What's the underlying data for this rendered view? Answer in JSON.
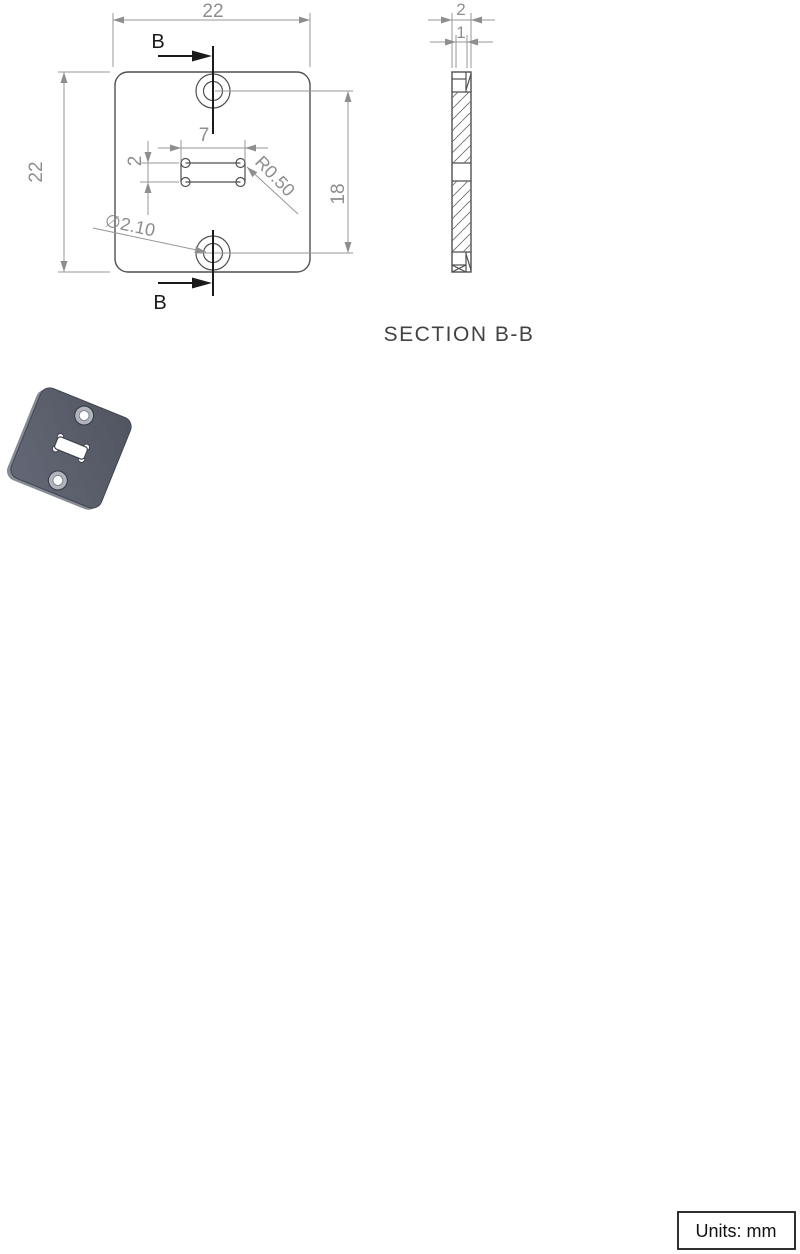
{
  "front_view": {
    "overall_width": "22",
    "overall_height": "22",
    "slot_length": "7",
    "slot_width": "2",
    "hole_spacing": "18",
    "slot_corner_radius": "R0.50",
    "hole_diameter": "∅2.10",
    "section_arrow_top": "B",
    "section_arrow_bottom": "B"
  },
  "section_view": {
    "overall_thickness": "2",
    "recess_thickness": "1",
    "caption": "SECTION B-B"
  },
  "footer": {
    "units_label": "Units: mm"
  },
  "colors": {
    "background": "#ffffff",
    "outline": "#4f4f4f",
    "dimension": "#8e8e8e",
    "section_marker": "#1a1a1a",
    "part_body": "#565b68",
    "part_side": "#868a94",
    "counterbore_ring": "#b2b5bd"
  }
}
